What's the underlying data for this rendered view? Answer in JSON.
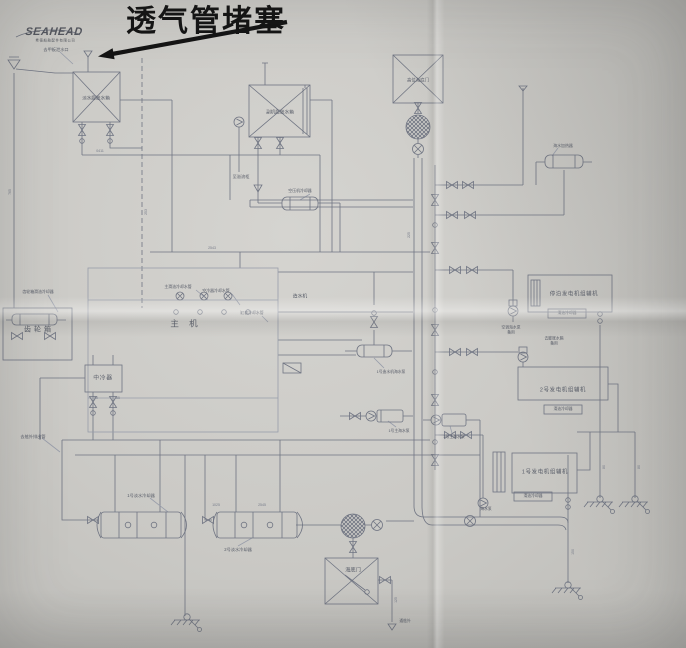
{
  "logo": {
    "title": "SEAHEAD",
    "subtitle": "希德船舶配件有限公司"
  },
  "annotation": {
    "text": "透气管堵塞"
  },
  "palette": {
    "paper": "#cac9c5",
    "ink": "#6f7482",
    "annotation_ink": "#141414"
  },
  "labels": [
    {
      "t": "去甲板泄水口",
      "x": 56,
      "y": 50,
      "fs": 4.2
    },
    {
      "t": "淡水膨胀水箱",
      "x": 96,
      "y": 98,
      "fs": 4.6,
      "name": "label-expansion-tank-1"
    },
    {
      "t": "副机膨胀水箱",
      "x": 280,
      "y": 112,
      "fs": 4.6,
      "name": "label-expansion-tank-2"
    },
    {
      "t": "至溢流柜",
      "x": 241,
      "y": 177,
      "fs": 4.2
    },
    {
      "t": "高位海底门",
      "x": 418,
      "y": 80,
      "fs": 4.4,
      "name": "label-high-sea-chest"
    },
    {
      "t": "海底门",
      "x": 353,
      "y": 570,
      "fs": 5.2,
      "name": "label-sea-chest"
    },
    {
      "t": "齿轮箱",
      "x": 39,
      "y": 331,
      "fs": 7,
      "ls": 3,
      "name": "label-gearbox"
    },
    {
      "t": "主 机",
      "x": 186,
      "y": 324,
      "fs": 8.5,
      "ls": 4,
      "name": "label-main-engine"
    },
    {
      "t": "中冷器",
      "x": 103,
      "y": 378,
      "fs": 5.8,
      "ls": 1.5,
      "name": "label-intercooler"
    },
    {
      "t": "造水机",
      "x": 300,
      "y": 296,
      "fs": 4.8,
      "name": "label-fw-generator"
    },
    {
      "t": "齿轮箱滑油冷却器",
      "x": 38,
      "y": 292,
      "fs": 3.9
    },
    {
      "t": "主滑油冷却水管",
      "x": 178,
      "y": 287,
      "fs": 3.9
    },
    {
      "t": "空冷器冷却水管",
      "x": 216,
      "y": 291,
      "fs": 3.9
    },
    {
      "t": "缸套冷却水管",
      "x": 252,
      "y": 313,
      "fs": 3.9
    },
    {
      "t": "空压机冷却器",
      "x": 300,
      "y": 191,
      "fs": 3.9
    },
    {
      "t": "海水加热器",
      "x": 563,
      "y": 146,
      "fs": 3.9
    },
    {
      "t": "停泊发电机组辅机",
      "x": 574,
      "y": 294,
      "fs": 5.4,
      "ls": 1.5,
      "name": "label-harbor-genset"
    },
    {
      "t": "滑油冷却器",
      "x": 567,
      "y": 313,
      "fs": 3.8
    },
    {
      "t": "空调海水泵\n备用",
      "x": 511,
      "y": 330,
      "fs": 3.8,
      "pre": true
    },
    {
      "t": "去膨胀水箱\n备用",
      "x": 554,
      "y": 341,
      "fs": 3.8,
      "pre": true
    },
    {
      "t": "2号发电机组辅机",
      "x": 563,
      "y": 390,
      "fs": 5.4,
      "ls": 1.5,
      "name": "label-genset-2"
    },
    {
      "t": "滑油冷却器",
      "x": 563,
      "y": 409,
      "fs": 3.8
    },
    {
      "t": "1号发电机组辅机",
      "x": 545,
      "y": 472,
      "fs": 5.4,
      "ls": 1.5,
      "name": "label-genset-1"
    },
    {
      "t": "滑油冷却器",
      "x": 533,
      "y": 496,
      "fs": 3.8
    },
    {
      "t": "海水泵",
      "x": 486,
      "y": 509,
      "fs": 3.8
    },
    {
      "t": "1号淡水冷却器",
      "x": 141,
      "y": 496,
      "fs": 4.2,
      "name": "label-cooler-1"
    },
    {
      "t": "2号淡水冷却器",
      "x": 238,
      "y": 550,
      "fs": 4.2,
      "name": "label-cooler-2"
    },
    {
      "t": "1号造水机海水泵",
      "x": 391,
      "y": 372,
      "fs": 3.8
    },
    {
      "t": "1号主海水泵",
      "x": 399,
      "y": 431,
      "fs": 3.8
    },
    {
      "t": "2号主海水泵",
      "x": 454,
      "y": 437,
      "fs": 3.8
    },
    {
      "t": "去舷外排出管",
      "x": 33,
      "y": 437,
      "fs": 4.2
    },
    {
      "t": "通舷外",
      "x": 405,
      "y": 621,
      "fs": 3.8
    },
    {
      "t": "0411",
      "x": 100,
      "y": 151,
      "fs": 3.5,
      "c": "dim"
    },
    {
      "t": "2543",
      "x": 212,
      "y": 248,
      "fs": 3.5,
      "c": "dim"
    },
    {
      "t": "765",
      "x": 10,
      "y": 192,
      "fs": 3.5,
      "rot": -90,
      "c": "dim"
    },
    {
      "t": "225",
      "x": 409,
      "y": 235,
      "fs": 3.5,
      "rot": -90,
      "c": "dim"
    },
    {
      "t": "253",
      "x": 146,
      "y": 212,
      "fs": 3.5,
      "rot": -90,
      "c": "dim"
    },
    {
      "t": "1025",
      "x": 216,
      "y": 505,
      "fs": 3.5,
      "c": "dim"
    },
    {
      "t": "2545",
      "x": 262,
      "y": 505,
      "fs": 3.5,
      "c": "dim"
    },
    {
      "t": "40",
      "x": 96,
      "y": 398,
      "fs": 3.5,
      "c": "dim"
    },
    {
      "t": "65",
      "x": 118,
      "y": 398,
      "fs": 3.5,
      "c": "dim"
    },
    {
      "t": "150",
      "x": 573,
      "y": 552,
      "fs": 3.5,
      "rot": -90,
      "c": "dim"
    },
    {
      "t": "80",
      "x": 604,
      "y": 467,
      "fs": 3.5,
      "rot": -90,
      "c": "dim"
    },
    {
      "t": "80",
      "x": 639,
      "y": 467,
      "fs": 3.5,
      "rot": -90,
      "c": "dim"
    },
    {
      "t": "125",
      "x": 396,
      "y": 600,
      "fs": 3.5,
      "rot": -90,
      "c": "dim"
    }
  ]
}
